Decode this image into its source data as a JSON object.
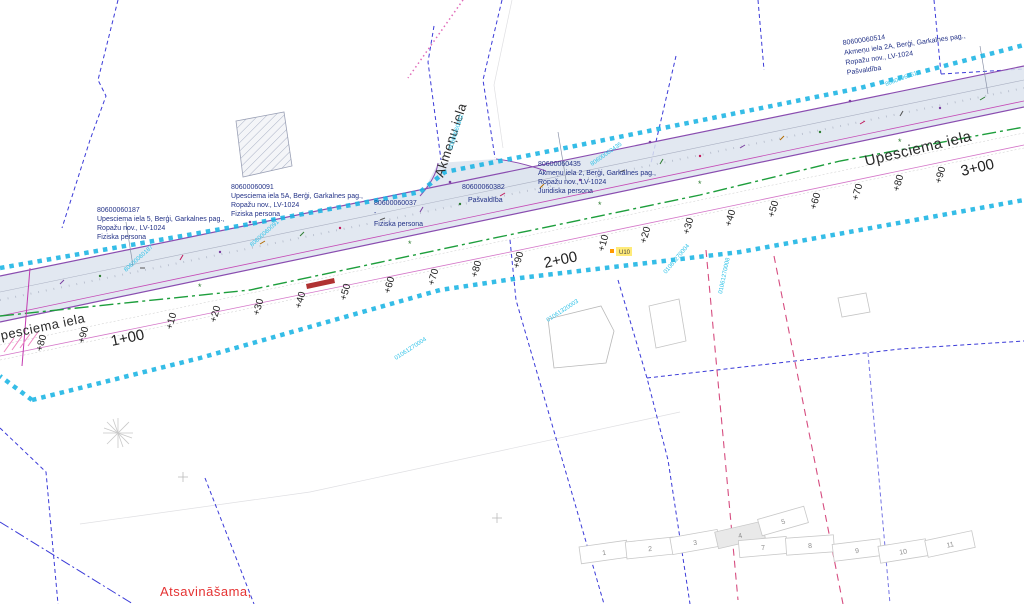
{
  "map": {
    "streets": {
      "upesciema_left": "Upesciema iela",
      "upesciema_right": "Upesciema iela",
      "akmenu": "Akmeņu iela"
    },
    "stations": [
      "+70",
      "+80",
      "+90",
      "1+00",
      "+10",
      "+20",
      "+30",
      "+40",
      "+50",
      "+60",
      "+70",
      "+80",
      "+90",
      "2+00",
      "+10",
      "+20",
      "+30",
      "+40",
      "+50",
      "+60",
      "+70",
      "+80",
      "+90",
      "3+00"
    ],
    "parcels": {
      "p0187": {
        "id": "80600060187",
        "address": "Upesciema iela 5, Berģi, Garkalnes pag.,",
        "address2": "Ropažu nov., LV-1024",
        "owner": "Fiziska persona"
      },
      "p0091": {
        "id": "80600060091",
        "address": "Upesciema iela 5A, Berģi, Garkalnes pag.,",
        "address2": "Ropažu nov., LV-1024",
        "owner": "Fiziska persona"
      },
      "p0037": {
        "id": "80600060037",
        "address": "-",
        "owner": "Fiziska persona"
      },
      "p0382": {
        "id": "80600060382",
        "owner": "Pašvaldība"
      },
      "p0435": {
        "id": "80600060435",
        "address": "Akmeņu iela 2, Berģi, Garkalnes pag.,",
        "address2": "Ropažu nov., LV-1024",
        "owner": "Juridiska persona"
      },
      "p0514": {
        "id": "80600060514",
        "address": "Akmeņu iela 2A, Berģi, Garkalnes pag.,",
        "address2": "Ropažu nov., LV-1024",
        "owner": "Pašvaldība"
      }
    },
    "boundary_ids": [
      "80600060187",
      "80600060091",
      "80600060162",
      "80600060435",
      "80600060514",
      "01061270004",
      "01061320003",
      "01061270004",
      "01061270008"
    ],
    "notes": {
      "expropriation": "Atsavināšama,",
      "utility_label": "U10"
    },
    "sheet_index": [
      "1",
      "2",
      "3",
      "4",
      "5",
      "7",
      "8",
      "9",
      "10",
      "11"
    ],
    "colors": {
      "boundary_cyan": "#1ab4e4",
      "parcel_blue": "#3b3bd8",
      "green_line": "#1d9e3c",
      "road_edge_purple": "#8a4db0",
      "magenta": "#c23ab0",
      "crimson": "#cc2060",
      "label_navy": "#233287",
      "note_red": "#e53333"
    }
  }
}
